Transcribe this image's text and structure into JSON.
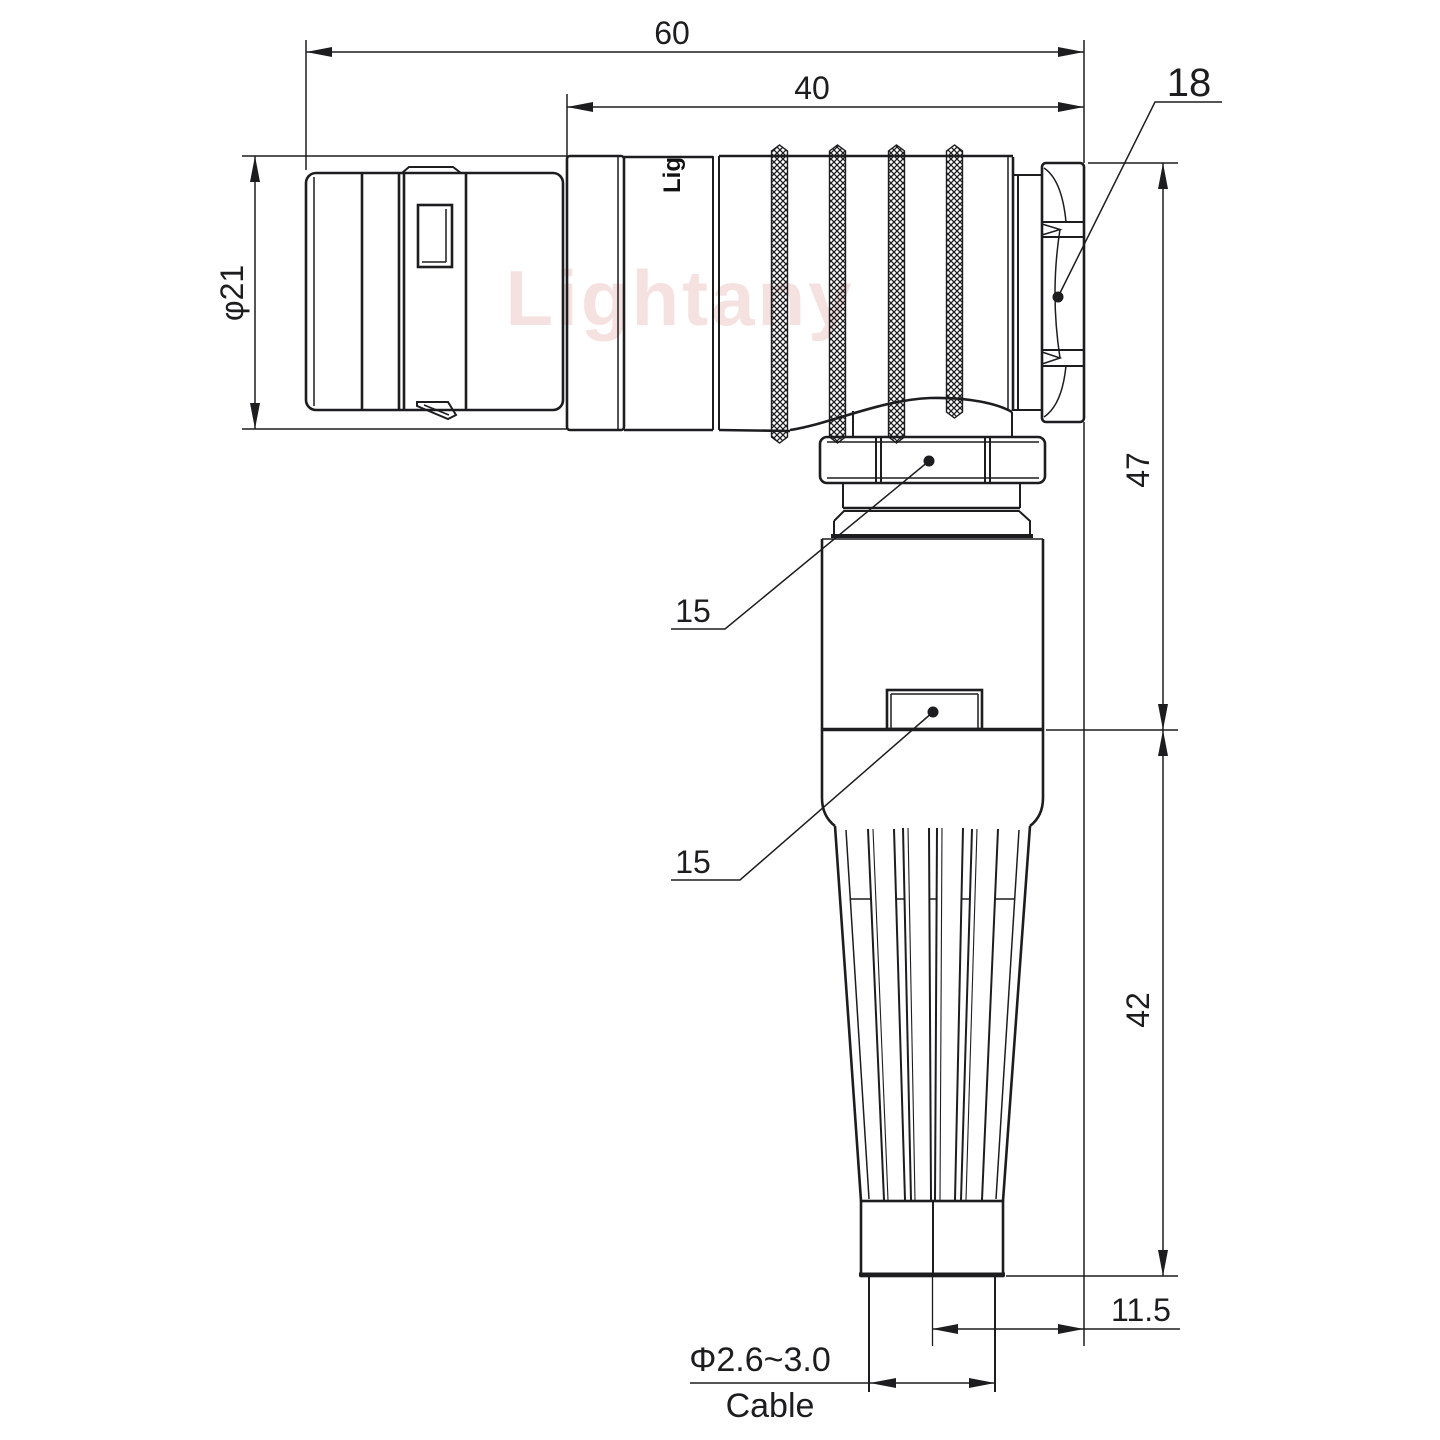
{
  "drawing": {
    "watermark": "Lightany",
    "part_logo": "Lig",
    "dimensions": {
      "overall_length": "60",
      "rear_length": "40",
      "hex_nut_width": "18",
      "front_diameter": "φ21",
      "upper_height": "47",
      "lower_height": "42",
      "cable_axis_offset": "11.5",
      "cable_diameter_range": "Φ2.6~3.0",
      "cable_label": "Cable",
      "backnut_flats": "15",
      "body_flats": "15"
    }
  }
}
